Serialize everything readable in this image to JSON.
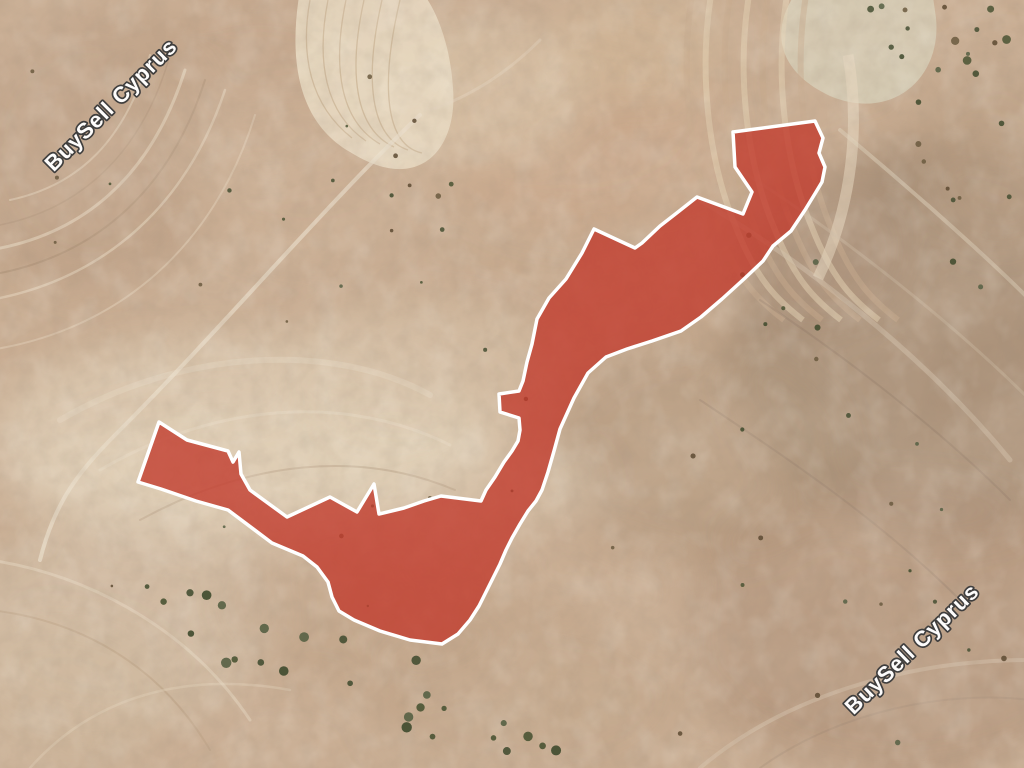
{
  "map": {
    "type": "satellite",
    "width": 1024,
    "height": 768
  },
  "watermark": {
    "text": "BuySell Cyprus",
    "text_color": "#ffffff",
    "outline_color": "#3b3b3b",
    "instances": [
      {
        "position": "top-left",
        "svg_transform": "translate(112 106) rotate(-45)"
      },
      {
        "position": "bottom-right",
        "svg_transform": "translate(913 650) rotate(-44)"
      }
    ]
  },
  "parcel": {
    "fill_color": "#c23a2c",
    "fill_opacity": 0.78,
    "stroke_color": "#ffffff",
    "stroke_width": 3.5,
    "points": [
      [
        733,
        132
      ],
      [
        815,
        121
      ],
      [
        823,
        138
      ],
      [
        819,
        153
      ],
      [
        825,
        167
      ],
      [
        822,
        182
      ],
      [
        816,
        192
      ],
      [
        805,
        210
      ],
      [
        791,
        231
      ],
      [
        773,
        246
      ],
      [
        763,
        261
      ],
      [
        744,
        279
      ],
      [
        722,
        299
      ],
      [
        701,
        317
      ],
      [
        681,
        331
      ],
      [
        652,
        341
      ],
      [
        627,
        349
      ],
      [
        606,
        357
      ],
      [
        588,
        373
      ],
      [
        574,
        398
      ],
      [
        560,
        429
      ],
      [
        554,
        451
      ],
      [
        548,
        472
      ],
      [
        542,
        490
      ],
      [
        536,
        501
      ],
      [
        528,
        511
      ],
      [
        520,
        524
      ],
      [
        512,
        538
      ],
      [
        506,
        550
      ],
      [
        500,
        564
      ],
      [
        493,
        578
      ],
      [
        486,
        592
      ],
      [
        479,
        606
      ],
      [
        470,
        620
      ],
      [
        458,
        634
      ],
      [
        442,
        644
      ],
      [
        410,
        640
      ],
      [
        380,
        631
      ],
      [
        354,
        620
      ],
      [
        339,
        611
      ],
      [
        332,
        597
      ],
      [
        328,
        582
      ],
      [
        317,
        567
      ],
      [
        303,
        556
      ],
      [
        272,
        543
      ],
      [
        228,
        510
      ],
      [
        196,
        501
      ],
      [
        161,
        489
      ],
      [
        138,
        482
      ],
      [
        159,
        422
      ],
      [
        187,
        440
      ],
      [
        228,
        451
      ],
      [
        233,
        462
      ],
      [
        239,
        452
      ],
      [
        241,
        474
      ],
      [
        250,
        490
      ],
      [
        287,
        517
      ],
      [
        330,
        497
      ],
      [
        357,
        512
      ],
      [
        374,
        484
      ],
      [
        379,
        514
      ],
      [
        404,
        508
      ],
      [
        424,
        501
      ],
      [
        441,
        496
      ],
      [
        481,
        501
      ],
      [
        486,
        490
      ],
      [
        495,
        477
      ],
      [
        504,
        462
      ],
      [
        512,
        451
      ],
      [
        518,
        441
      ],
      [
        520,
        430
      ],
      [
        519,
        418
      ],
      [
        500,
        412
      ],
      [
        499,
        394
      ],
      [
        519,
        391
      ],
      [
        523,
        381
      ],
      [
        527,
        362
      ],
      [
        532,
        344
      ],
      [
        537,
        319
      ],
      [
        549,
        298
      ],
      [
        566,
        279
      ],
      [
        582,
        253
      ],
      [
        594,
        229
      ],
      [
        622,
        242
      ],
      [
        635,
        248
      ],
      [
        642,
        243
      ],
      [
        660,
        226
      ],
      [
        678,
        212
      ],
      [
        697,
        197
      ],
      [
        743,
        214
      ],
      [
        752,
        192
      ],
      [
        735,
        167
      ]
    ]
  }
}
